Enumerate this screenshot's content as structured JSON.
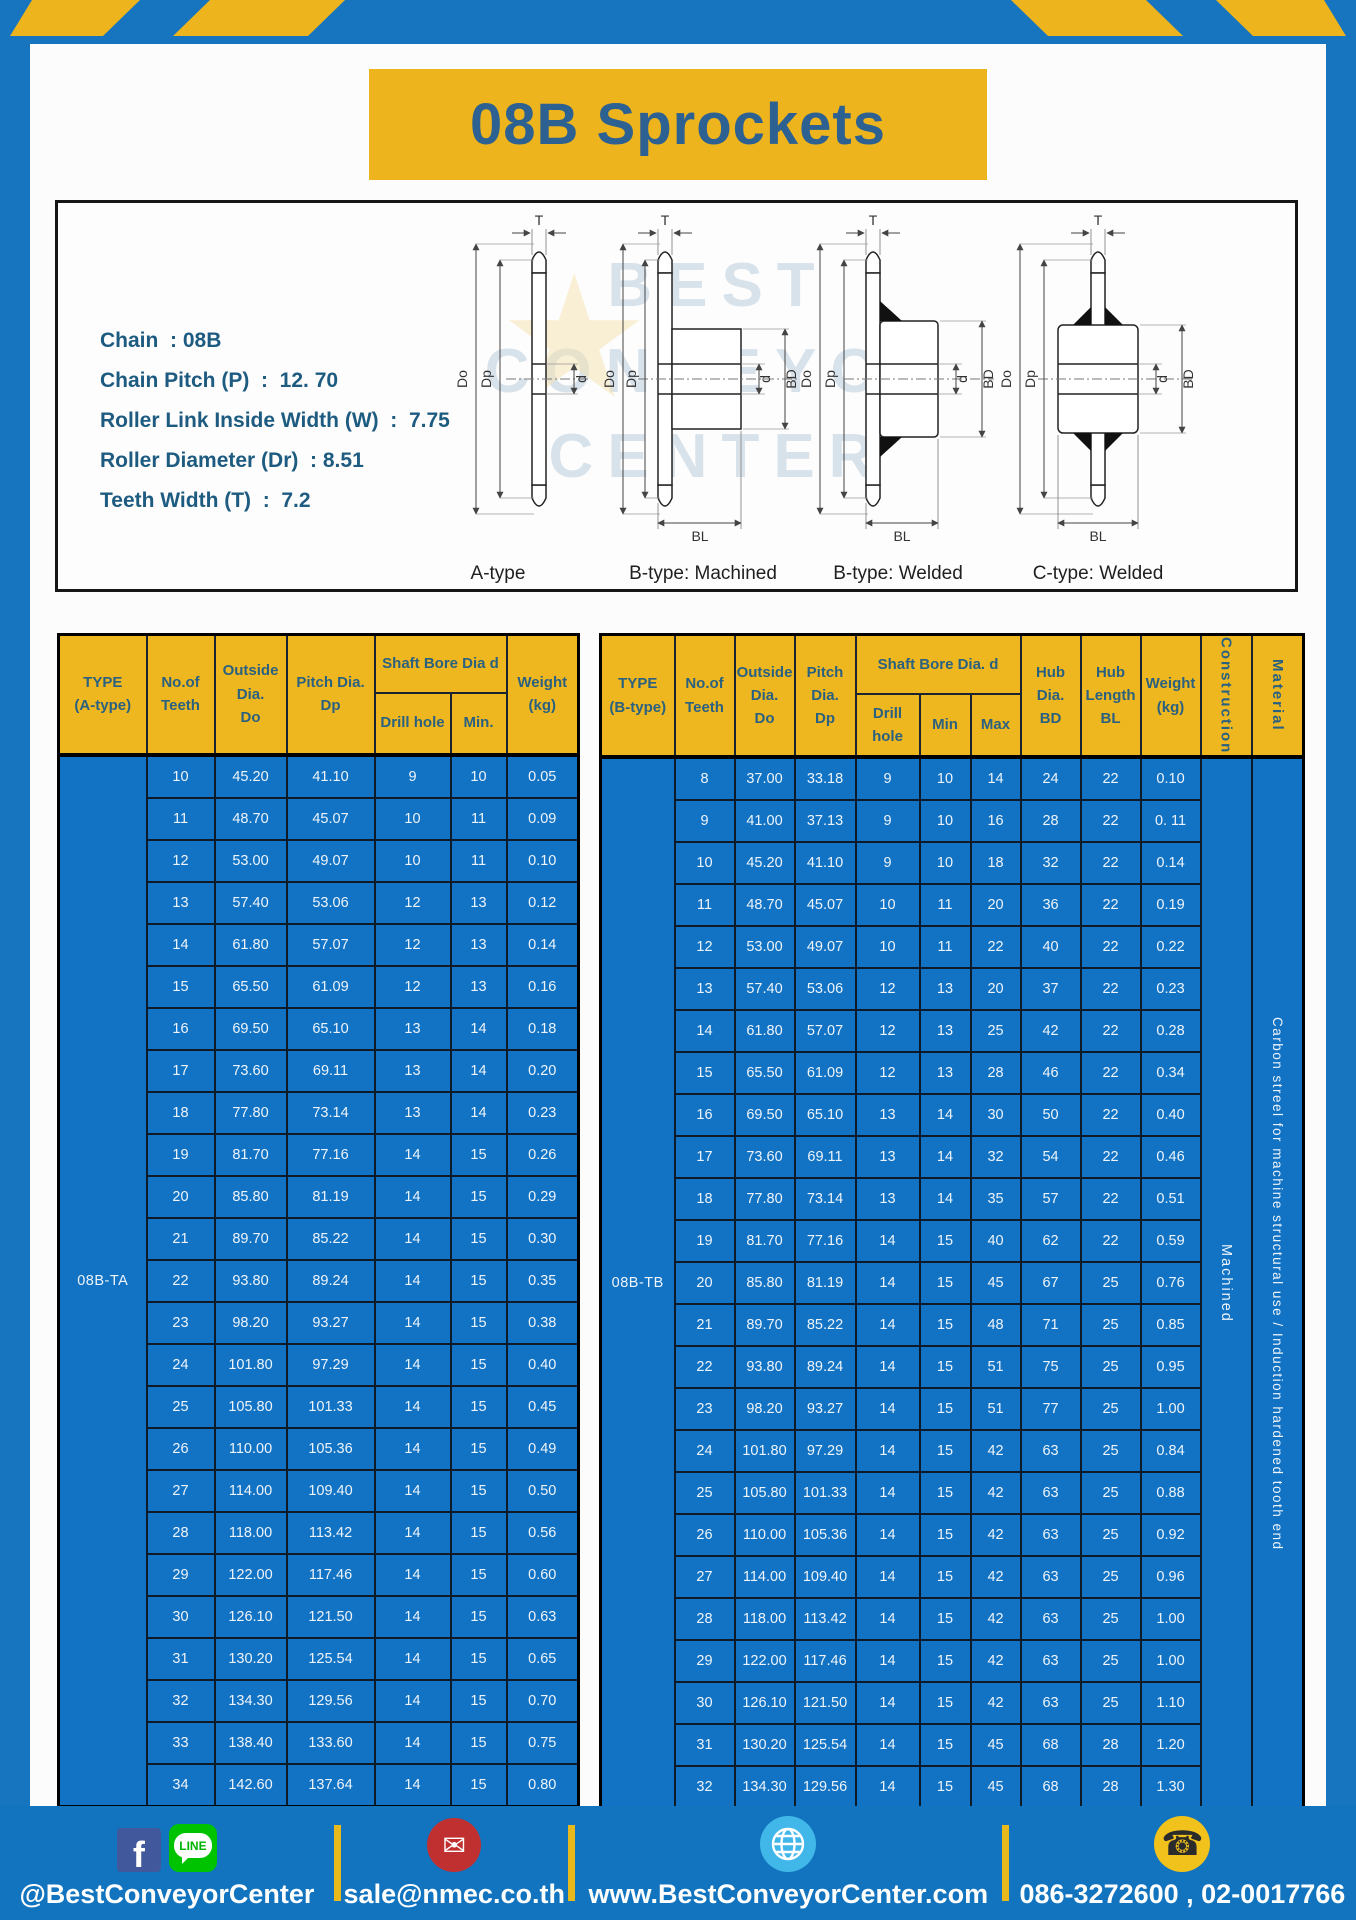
{
  "colors": {
    "frame_blue": "#1774bf",
    "accent_yellow": "#edb41d",
    "table_cell_blue": "#1273c4",
    "header_yellow": "#efb71f",
    "title_text": "#2d6191",
    "spec_text": "#1d5b80"
  },
  "title": "08B Sprockets",
  "specs": [
    "Chain  : 08B",
    "Chain Pitch (P)  :  12. 70",
    "Roller Link Inside Width (W)  :  7.75",
    "Roller Diameter (Dr)  : 8.51",
    "Teeth Width (T)  :  7.2"
  ],
  "diagram": {
    "captions": [
      "A-type",
      "B-type: Machined",
      "B-type: Welded",
      "C-type: Welded"
    ],
    "dims": {
      "t": "T",
      "do": "Do",
      "dp": "Dp",
      "d": "d",
      "bd": "BD",
      "bl": "BL"
    }
  },
  "watermark": {
    "line1": "BEST",
    "line2": "CONVEYOR",
    "line3": "CENTER",
    "star_glyph": "★"
  },
  "table_a": {
    "type_label": "08B-TA",
    "headers": {
      "type": "TYPE\n(A-type)",
      "teeth": "No.of\nTeeth",
      "outside": "Outside\nDia.\nDo",
      "pitch": "Pitch Dia.\nDp",
      "shaft_bore": "Shaft Bore Dia d",
      "drill": "Drill hole",
      "min": "Min.",
      "weight": "Weight\n(kg)"
    },
    "rows": [
      [
        "10",
        "45.20",
        "41.10",
        "9",
        "10",
        "0.05"
      ],
      [
        "11",
        "48.70",
        "45.07",
        "10",
        "11",
        "0.09"
      ],
      [
        "12",
        "53.00",
        "49.07",
        "10",
        "11",
        "0.10"
      ],
      [
        "13",
        "57.40",
        "53.06",
        "12",
        "13",
        "0.12"
      ],
      [
        "14",
        "61.80",
        "57.07",
        "12",
        "13",
        "0.14"
      ],
      [
        "15",
        "65.50",
        "61.09",
        "12",
        "13",
        "0.16"
      ],
      [
        "16",
        "69.50",
        "65.10",
        "13",
        "14",
        "0.18"
      ],
      [
        "17",
        "73.60",
        "69.11",
        "13",
        "14",
        "0.20"
      ],
      [
        "18",
        "77.80",
        "73.14",
        "13",
        "14",
        "0.23"
      ],
      [
        "19",
        "81.70",
        "77.16",
        "14",
        "15",
        "0.26"
      ],
      [
        "20",
        "85.80",
        "81.19",
        "14",
        "15",
        "0.29"
      ],
      [
        "21",
        "89.70",
        "85.22",
        "14",
        "15",
        "0.30"
      ],
      [
        "22",
        "93.80",
        "89.24",
        "14",
        "15",
        "0.35"
      ],
      [
        "23",
        "98.20",
        "93.27",
        "14",
        "15",
        "0.38"
      ],
      [
        "24",
        "101.80",
        "97.29",
        "14",
        "15",
        "0.40"
      ],
      [
        "25",
        "105.80",
        "101.33",
        "14",
        "15",
        "0.45"
      ],
      [
        "26",
        "110.00",
        "105.36",
        "14",
        "15",
        "0.49"
      ],
      [
        "27",
        "114.00",
        "109.40",
        "14",
        "15",
        "0.50"
      ],
      [
        "28",
        "118.00",
        "113.42",
        "14",
        "15",
        "0.56"
      ],
      [
        "29",
        "122.00",
        "117.46",
        "14",
        "15",
        "0.60"
      ],
      [
        "30",
        "126.10",
        "121.50",
        "14",
        "15",
        "0.63"
      ],
      [
        "31",
        "130.20",
        "125.54",
        "14",
        "15",
        "0.65"
      ],
      [
        "32",
        "134.30",
        "129.56",
        "14",
        "15",
        "0.70"
      ],
      [
        "33",
        "138.40",
        "133.60",
        "14",
        "15",
        "0.75"
      ],
      [
        "34",
        "142.60",
        "137.64",
        "14",
        "15",
        "0.80"
      ]
    ]
  },
  "table_b": {
    "type_label": "08B-TB",
    "headers": {
      "type": "TYPE\n(B-type)",
      "teeth": "No.of\nTeeth",
      "outside": "Outside\nDia.\nDo",
      "pitch": "Pitch\nDia.\nDp",
      "shaft_bore": "Shaft Bore Dia.  d",
      "drill": "Drill hole",
      "min": "Min",
      "max": "Max",
      "hub_dia": "Hub\nDia.\nBD",
      "hub_len": "Hub\nLength\nBL",
      "weight": "Weight\n(kg)",
      "construction": "Construction",
      "material": "Material"
    },
    "extra": [
      "Machined",
      "Carbon streel for machine structural use / Induction hardened tooth end"
    ],
    "rows": [
      [
        "8",
        "37.00",
        "33.18",
        "9",
        "10",
        "14",
        "24",
        "22",
        "0.10"
      ],
      [
        "9",
        "41.00",
        "37.13",
        "9",
        "10",
        "16",
        "28",
        "22",
        "0. 11"
      ],
      [
        "10",
        "45.20",
        "41.10",
        "9",
        "10",
        "18",
        "32",
        "22",
        "0.14"
      ],
      [
        "11",
        "48.70",
        "45.07",
        "10",
        "11",
        "20",
        "36",
        "22",
        "0.19"
      ],
      [
        "12",
        "53.00",
        "49.07",
        "10",
        "11",
        "22",
        "40",
        "22",
        "0.22"
      ],
      [
        "13",
        "57.40",
        "53.06",
        "12",
        "13",
        "20",
        "37",
        "22",
        "0.23"
      ],
      [
        "14",
        "61.80",
        "57.07",
        "12",
        "13",
        "25",
        "42",
        "22",
        "0.28"
      ],
      [
        "15",
        "65.50",
        "61.09",
        "12",
        "13",
        "28",
        "46",
        "22",
        "0.34"
      ],
      [
        "16",
        "69.50",
        "65.10",
        "13",
        "14",
        "30",
        "50",
        "22",
        "0.40"
      ],
      [
        "17",
        "73.60",
        "69.11",
        "13",
        "14",
        "32",
        "54",
        "22",
        "0.46"
      ],
      [
        "18",
        "77.80",
        "73.14",
        "13",
        "14",
        "35",
        "57",
        "22",
        "0.51"
      ],
      [
        "19",
        "81.70",
        "77.16",
        "14",
        "15",
        "40",
        "62",
        "22",
        "0.59"
      ],
      [
        "20",
        "85.80",
        "81.19",
        "14",
        "15",
        "45",
        "67",
        "25",
        "0.76"
      ],
      [
        "21",
        "89.70",
        "85.22",
        "14",
        "15",
        "48",
        "71",
        "25",
        "0.85"
      ],
      [
        "22",
        "93.80",
        "89.24",
        "14",
        "15",
        "51",
        "75",
        "25",
        "0.95"
      ],
      [
        "23",
        "98.20",
        "93.27",
        "14",
        "15",
        "51",
        "77",
        "25",
        "1.00"
      ],
      [
        "24",
        "101.80",
        "97.29",
        "14",
        "15",
        "42",
        "63",
        "25",
        "0.84"
      ],
      [
        "25",
        "105.80",
        "101.33",
        "14",
        "15",
        "42",
        "63",
        "25",
        "0.88"
      ],
      [
        "26",
        "110.00",
        "105.36",
        "14",
        "15",
        "42",
        "63",
        "25",
        "0.92"
      ],
      [
        "27",
        "114.00",
        "109.40",
        "14",
        "15",
        "42",
        "63",
        "25",
        "0.96"
      ],
      [
        "28",
        "118.00",
        "113.42",
        "14",
        "15",
        "42",
        "63",
        "25",
        "1.00"
      ],
      [
        "29",
        "122.00",
        "117.46",
        "14",
        "15",
        "42",
        "63",
        "25",
        "1.00"
      ],
      [
        "30",
        "126.10",
        "121.50",
        "14",
        "15",
        "42",
        "63",
        "25",
        "1.10"
      ],
      [
        "31",
        "130.20",
        "125.54",
        "14",
        "15",
        "45",
        "68",
        "28",
        "1.20"
      ],
      [
        "32",
        "134.30",
        "129.56",
        "14",
        "15",
        "45",
        "68",
        "28",
        "1.30"
      ]
    ]
  },
  "footer": {
    "facebook_glyph": "f",
    "line_text": "LINE",
    "email_glyph": "✉",
    "phone_glyph": "☎",
    "social_label": "@BestConveyorCenter",
    "email": "sale@nmec.co.th",
    "website": "www.BestConveyorCenter.com",
    "phones": "086-3272600 , 02-0017766"
  }
}
